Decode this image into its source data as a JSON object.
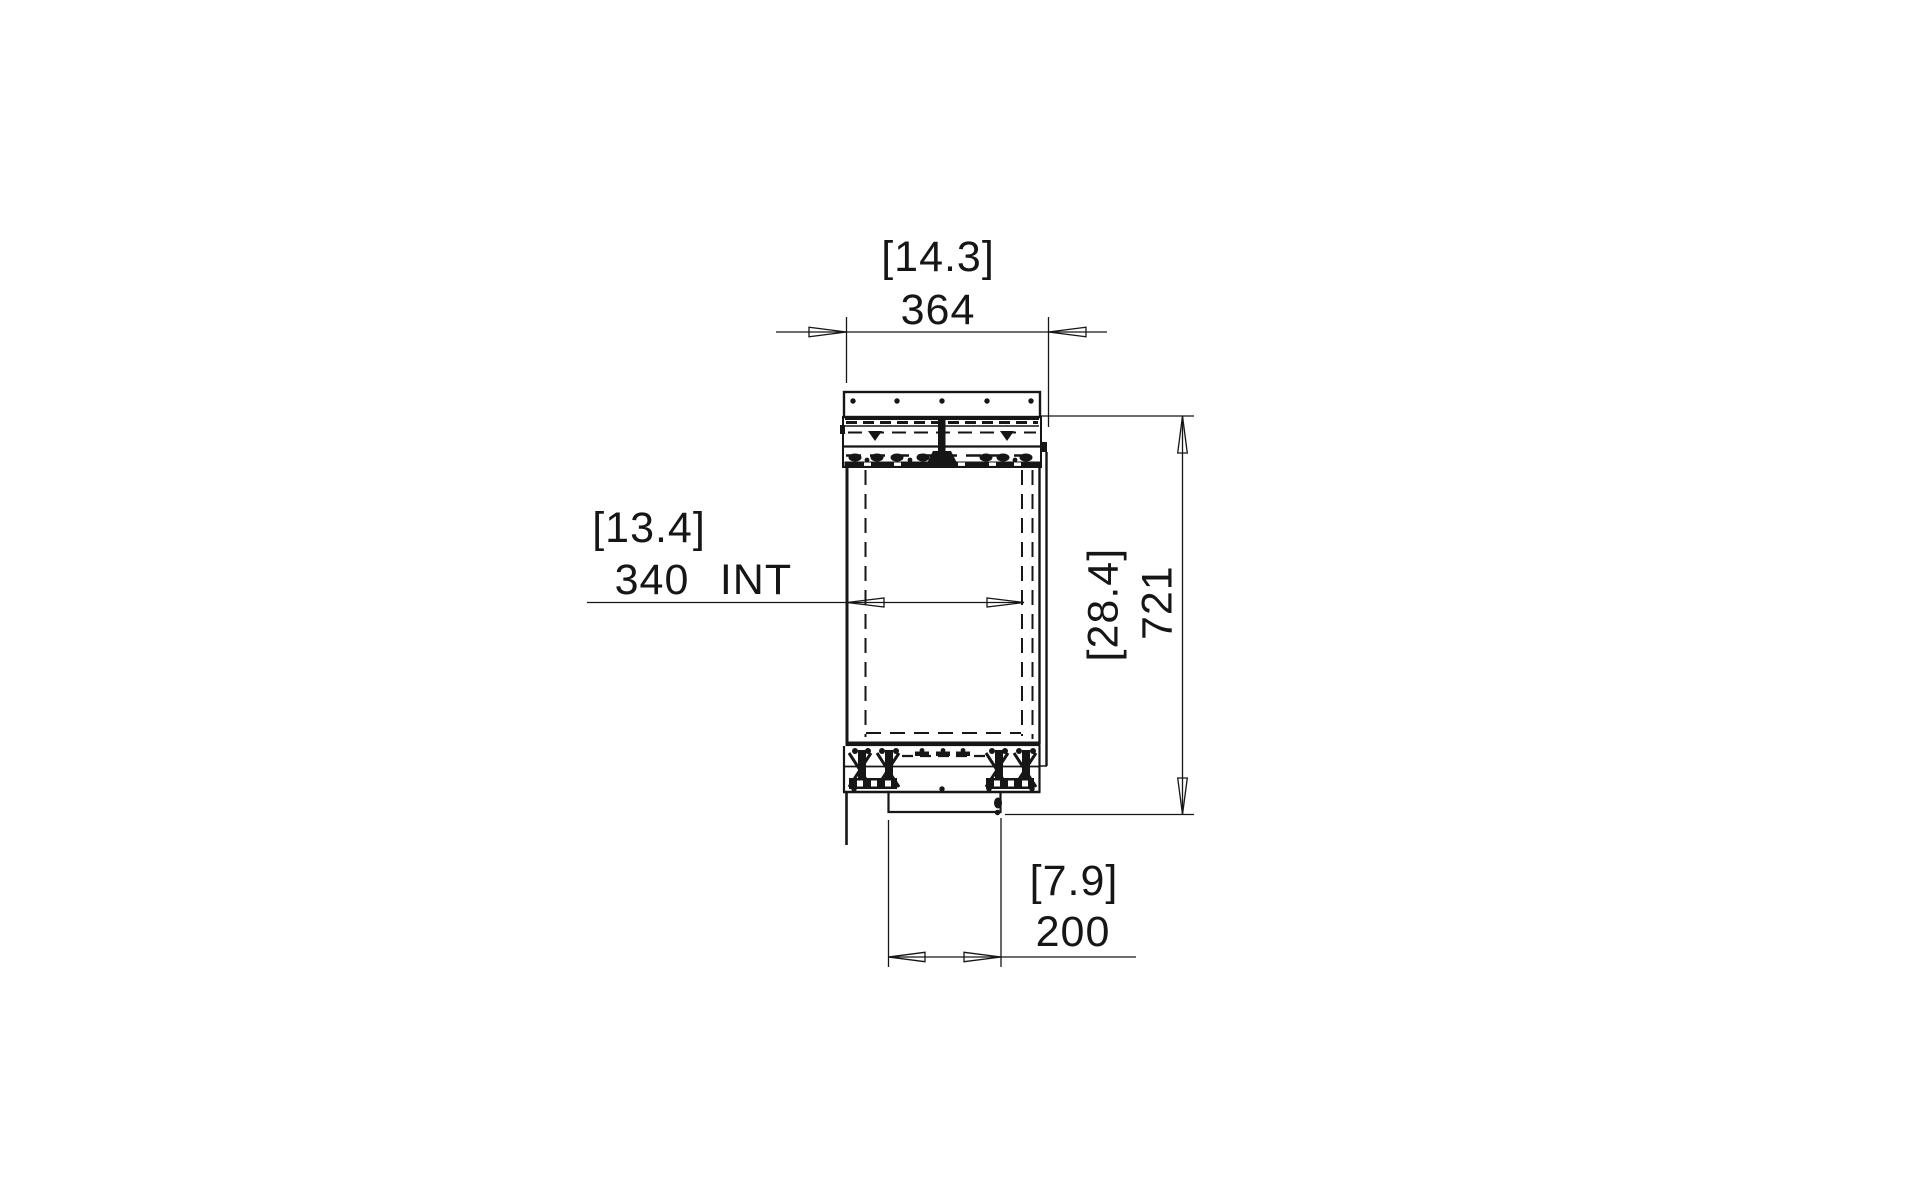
{
  "drawing": {
    "background": "#ffffff",
    "ink": "#161616",
    "description": "technical side-section drawing of built-in firebox with mounting flange, burner deck, insulated body, valve assembly and bottom inlet box",
    "labels": {
      "top_width": {
        "imperial": "[14.3]",
        "metric": "364"
      },
      "interior_width": {
        "imperial": "[13.4]",
        "metric": "340",
        "suffix": "INT"
      },
      "overall_height": {
        "imperial": "[28.4]",
        "metric": "721"
      },
      "bottom_width": {
        "imperial": "[7.9]",
        "metric": "200"
      }
    }
  }
}
